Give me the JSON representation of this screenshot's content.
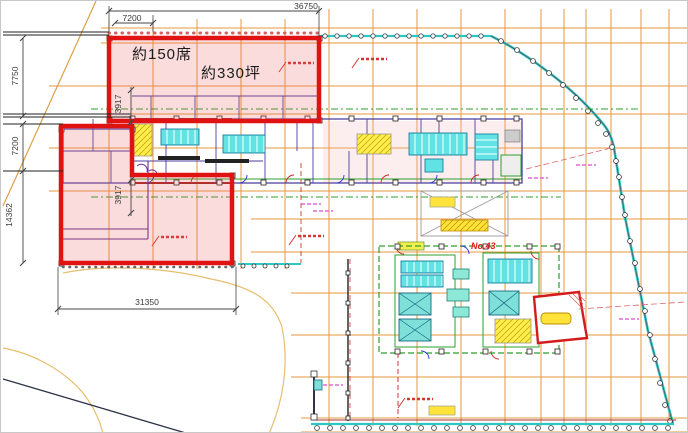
{
  "page": {
    "type": "architectural-floor-plan"
  },
  "colors": {
    "highlight_red": "#e01212",
    "highlight_fill": "rgba(233,96,96,0.22)",
    "grid_orange": "#e59a3c",
    "contour_orange": "#e6bf6e",
    "site_teal": "#2ec8c4",
    "fixture_cyan": "#62e3e3",
    "fixture_cyan_dark": "#1b7f9e",
    "elevator_teal": "#7fe0da",
    "stair_yellow": "#ffec4d",
    "ramp_yellow": "#ffe23a",
    "wall_purple": "#4a3f9f",
    "wall_darkred": "#a22222",
    "green": "#2ca02c",
    "annotation_red": "#d63333",
    "magenta": "#e06ad6",
    "dim_line": "#444444",
    "navy": "#2b3347"
  },
  "dimensions": {
    "top_total": "36750",
    "top_bay": "7200",
    "left_upper": "7750",
    "left_middle": "7200",
    "left_lower": "14362",
    "core_upper": "3917",
    "core_lower": "3917",
    "bottom_width": "31350"
  },
  "highlight_labels": {
    "seats": "約150席",
    "area": "約330坪"
  },
  "plan_labels": {
    "building_number": "No.43"
  }
}
